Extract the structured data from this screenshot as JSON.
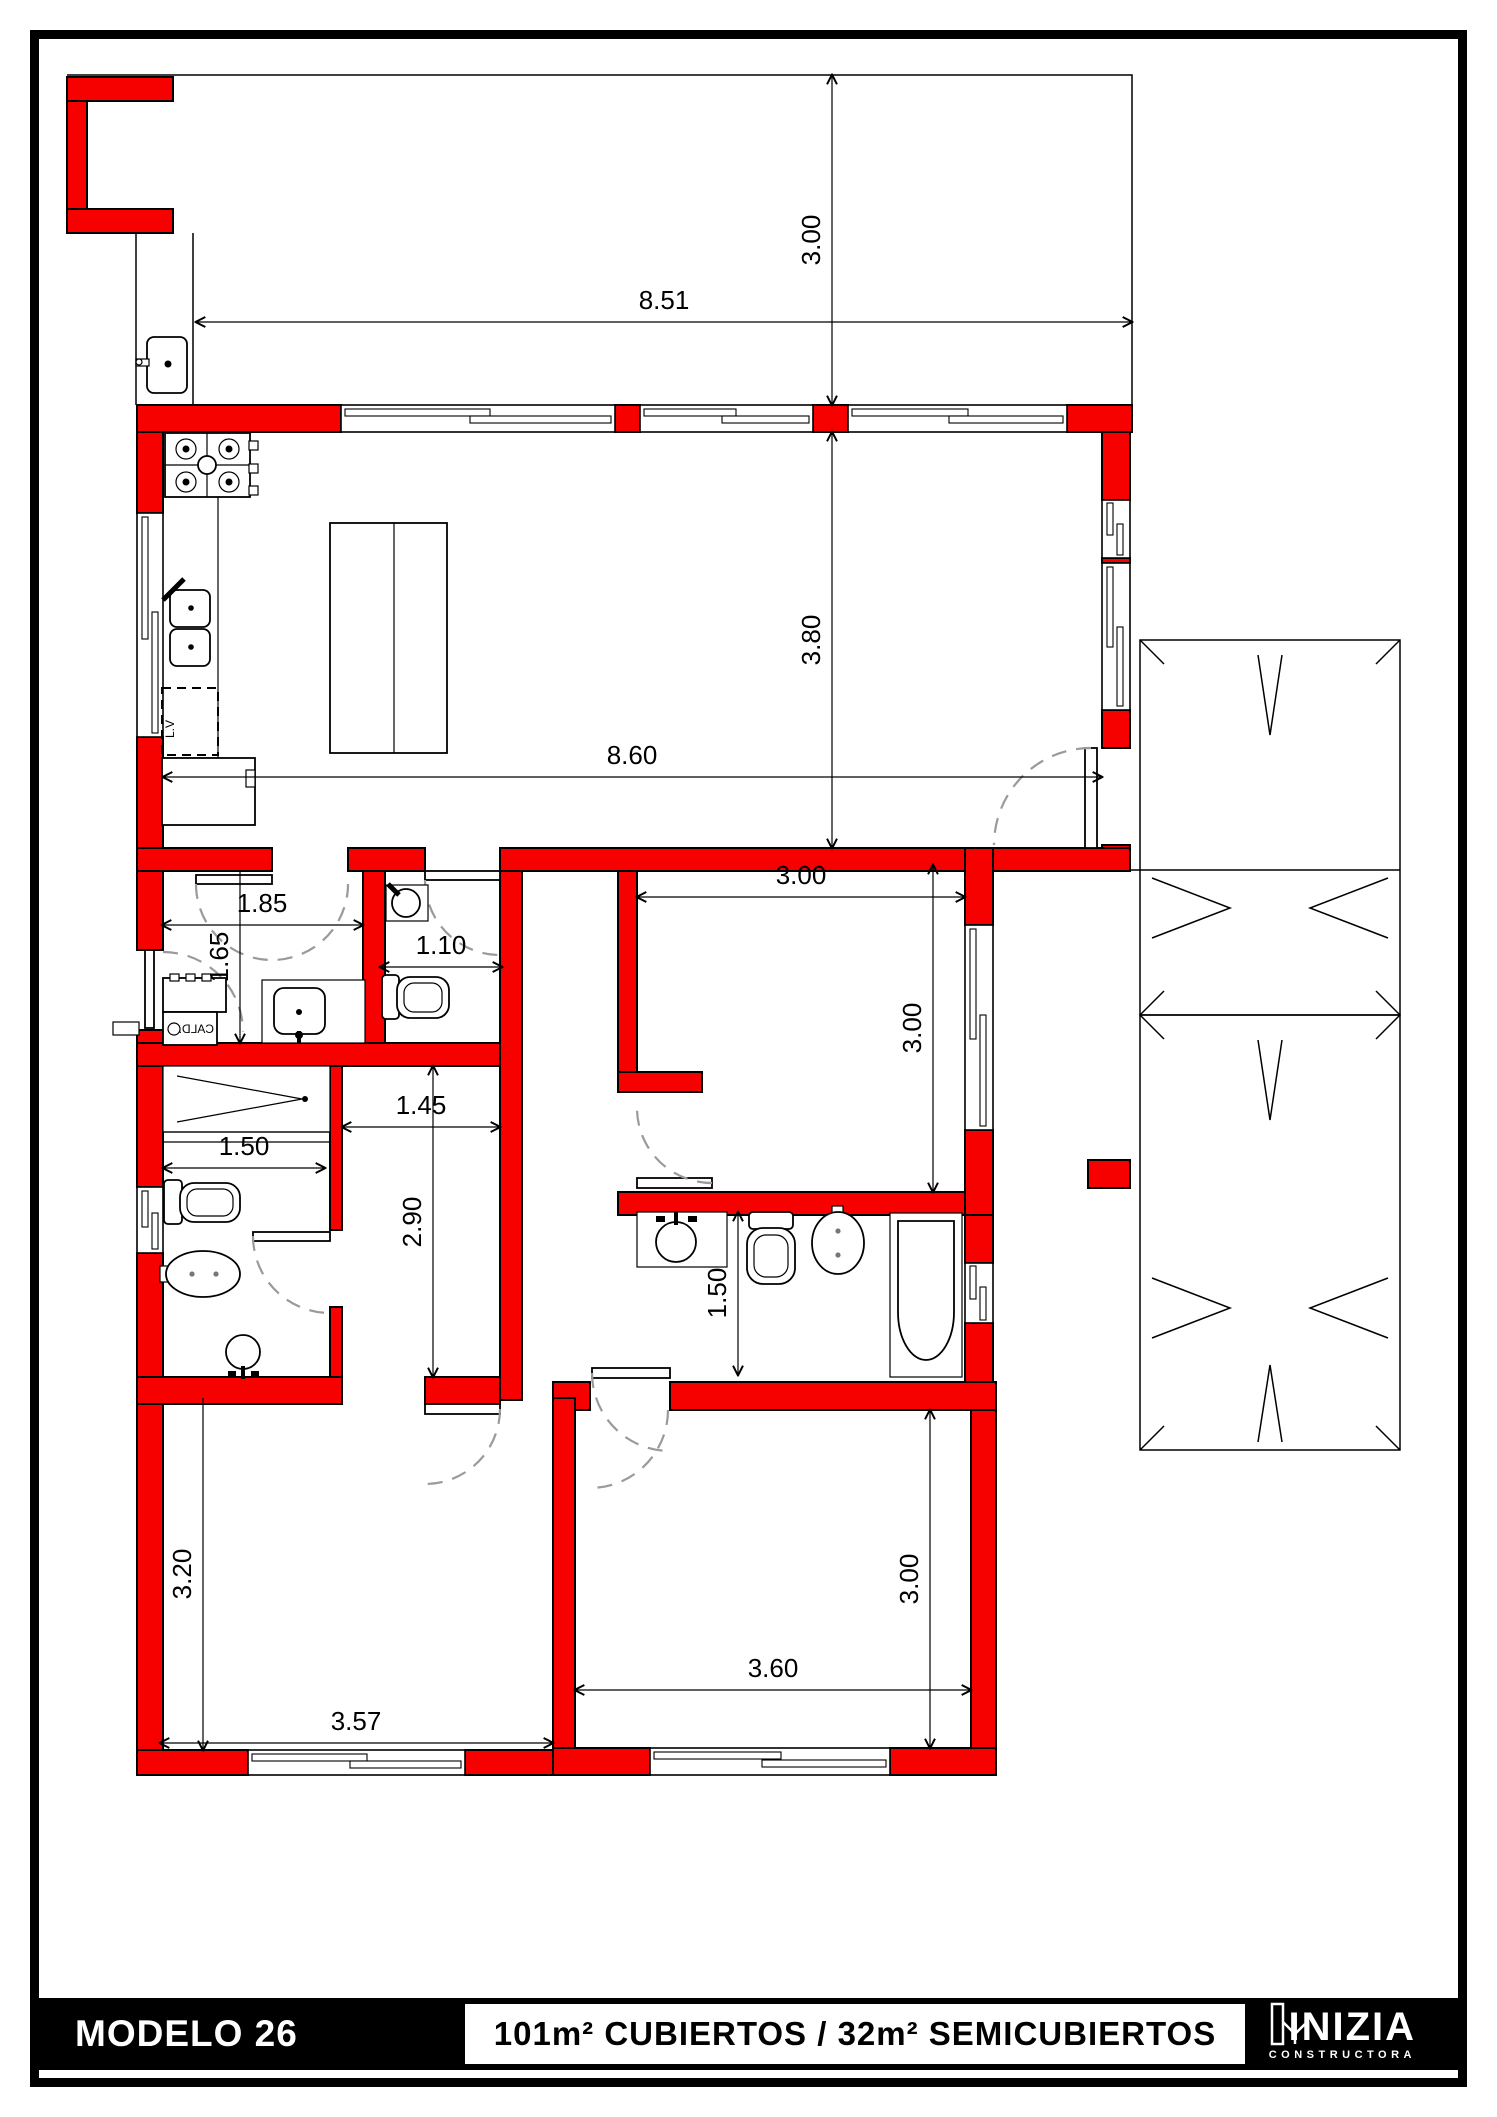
{
  "colors": {
    "wall": "#f60000",
    "line": "#000000",
    "arc": "#9a9a9a",
    "paper": "#ffffff",
    "footer_bg": "#000000"
  },
  "footer": {
    "model": "MODELO 26",
    "area_label": "101m² CUBIERTOS  /  32m² SEMICUBIERTOS",
    "logo": {
      "name": "INIZIA",
      "tagline": "CONSTRUCTORA"
    }
  },
  "labels": {
    "dishwasher": "L.V",
    "boiler": "CALD."
  },
  "dimensions": {
    "galeria_depth": "3.00",
    "frente": "8.51",
    "living_depth": "3.80",
    "living_width": "8.60",
    "hall_width": "1.85",
    "hall_depth": "1.65",
    "toilette_width": "1.10",
    "bedroom3_width": "3.00",
    "bedroom3_depth": "3.00",
    "pasillo_width": "1.45",
    "pasillo_length": "2.90",
    "shower_width": "1.50",
    "bath_depth": "1.50",
    "bedroom1_depth": "3.20",
    "bedroom1_width": "3.57",
    "bedroom2_width": "3.60",
    "bedroom2_depth": "3.00"
  }
}
